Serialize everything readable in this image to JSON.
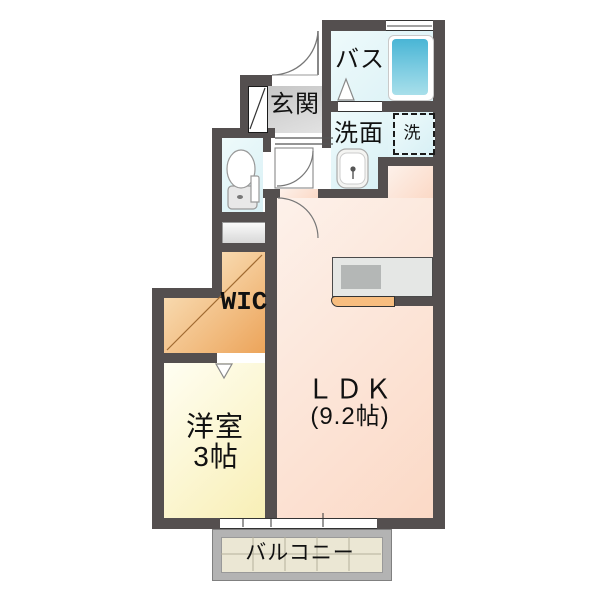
{
  "floorplan": {
    "rooms": {
      "bath": {
        "label": "バス"
      },
      "washroom": {
        "label": "洗面"
      },
      "washer": {
        "label": "洗"
      },
      "entrance": {
        "label": "玄関"
      },
      "wic": {
        "label": "WIC"
      },
      "ldk": {
        "label": "ＬＤＫ",
        "size": "(9.2帖)"
      },
      "western_room": {
        "label": "洋室",
        "size": "3帖"
      },
      "balcony": {
        "label": "バルコニー"
      }
    },
    "fixtures": [
      "bathtub-icon",
      "washing-machine-box",
      "sink-icon",
      "toilet-icon",
      "shoe-cabinet",
      "kitchen-counter",
      "door-arcs",
      "folding-door-marker"
    ],
    "colors": {
      "wall": "#544f4f",
      "water_rooms": "#ddf1f5",
      "entrance_floor": "#cccccc",
      "wic": "#f2b878",
      "western_room": "#fbf3c4",
      "ldk": "#fbdcca",
      "balcony_tile": "#ebe7d4",
      "bathtub": "#49b5d5",
      "kitchen_counter_front": "#f7bd7f"
    }
  }
}
